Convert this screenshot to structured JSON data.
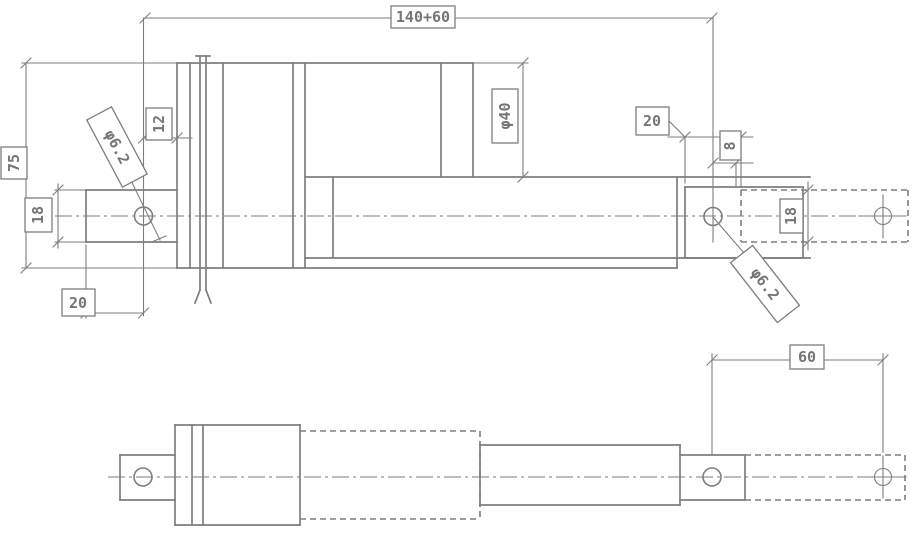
{
  "drawing": {
    "type": "engineering-drawing",
    "subject": "linear actuator, two orthographic views with retracted and extended (phantom) positions",
    "style": {
      "line_color": "#7e7e7e",
      "background": "#ffffff",
      "text_color": "#757575"
    },
    "labels": {
      "overall_length": "140+60",
      "body_height": "75",
      "pin_to_face": "12",
      "hole_dia_left": "φ6.2",
      "tab_height_left": "18",
      "tab_hole_offset": "20",
      "tube_dia": "φ40",
      "rod_end_offset": "20",
      "pin_edge_dist": "8",
      "tab_height_right": "18",
      "hole_dia_right": "φ6.2",
      "stroke_travel": "60"
    }
  }
}
